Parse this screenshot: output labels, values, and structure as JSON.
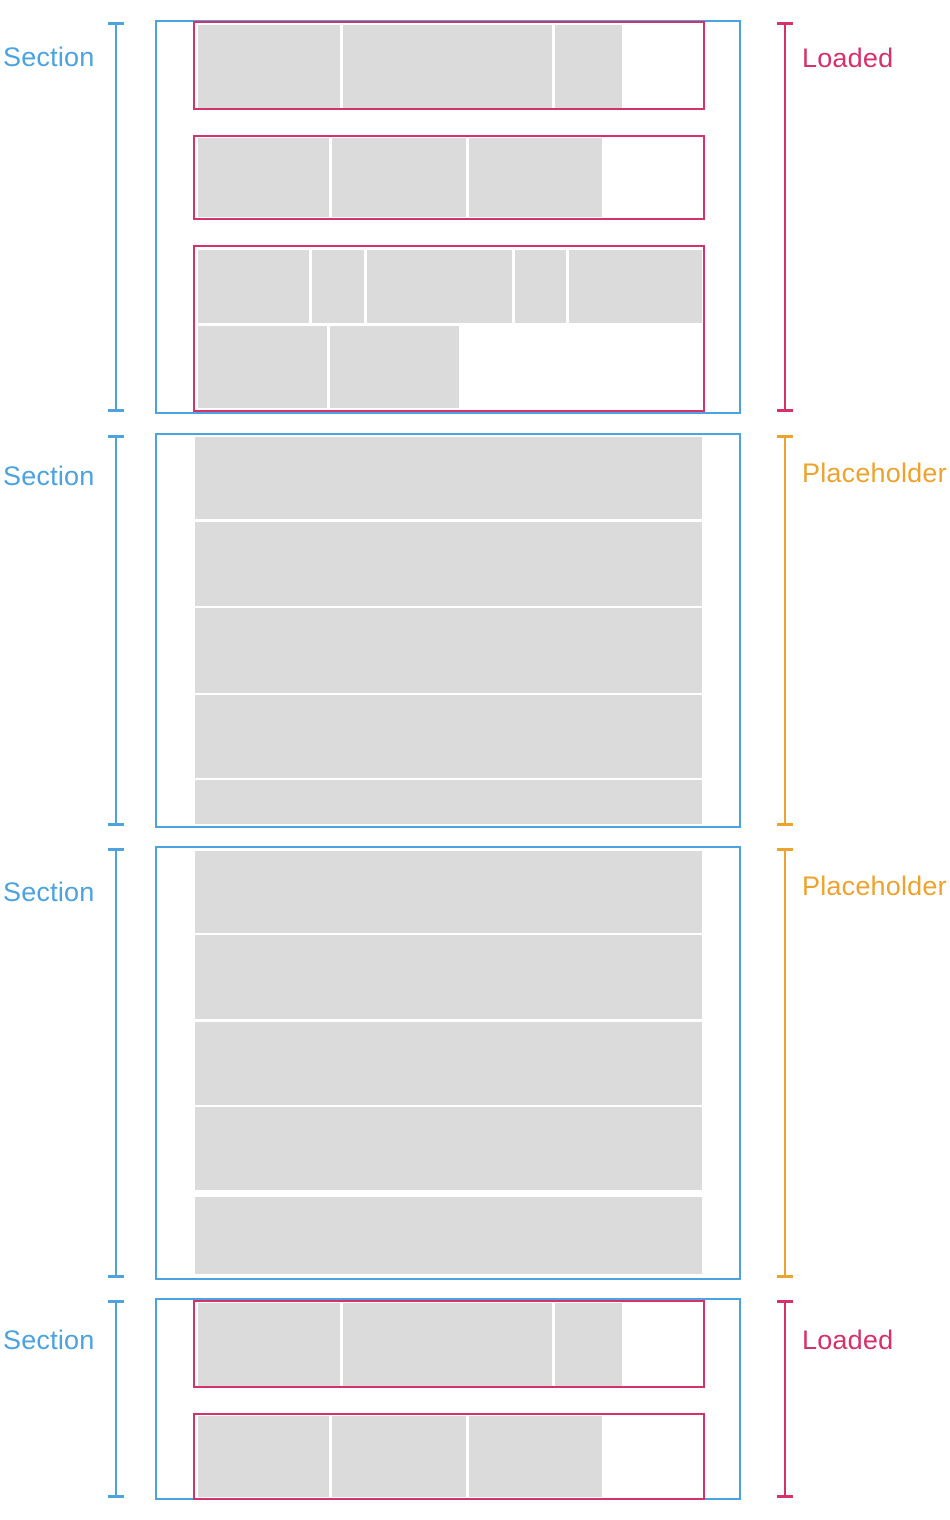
{
  "diagram_title": "Sections with loaded content and placeholder skeletons",
  "colors": {
    "section_outline_blue": "#4DA3DF",
    "loaded_pink": "#D5326B",
    "placeholder_orange": "#EDA32F",
    "skeleton_gray": "#DBDBDB",
    "background": "#FFFFFF"
  },
  "sections": [
    {
      "label": "Section",
      "state": "loaded",
      "state_label": "Loaded",
      "top": 20,
      "height": 394,
      "label_dy": 24,
      "state_label_dy": 25,
      "groups": [
        {
          "top": 1,
          "height": 89,
          "rows": [
            {
              "top": 4,
              "height": 83,
              "cells": [
                142,
                209,
                67
              ]
            }
          ]
        },
        {
          "top": 115,
          "height": 85,
          "rows": [
            {
              "top": 3,
              "height": 79,
              "cells": [
                131,
                134,
                133
              ]
            }
          ]
        },
        {
          "top": 225,
          "height": 167,
          "rows": [
            {
              "top": 5,
              "height": 73,
              "cells": [
                111,
                52,
                145,
                51,
                133
              ]
            },
            {
              "top": 81,
              "height": 82,
              "cells": [
                129,
                129
              ]
            }
          ]
        }
      ]
    },
    {
      "label": "Section",
      "state": "placeholder",
      "state_label": "Placeholder",
      "top": 433,
      "height": 395,
      "label_dy": 30,
      "state_label_dy": 27,
      "rows": [
        {
          "top": 4,
          "height": 82
        },
        {
          "top": 89,
          "height": 84
        },
        {
          "top": 175,
          "height": 85
        },
        {
          "top": 262,
          "height": 83
        },
        {
          "top": 347,
          "height": 44
        }
      ]
    },
    {
      "label": "Section",
      "state": "placeholder",
      "state_label": "Placeholder",
      "top": 846,
      "height": 434,
      "label_dy": 33,
      "state_label_dy": 27,
      "rows": [
        {
          "top": 5,
          "height": 82
        },
        {
          "top": 89,
          "height": 84
        },
        {
          "top": 176,
          "height": 83
        },
        {
          "top": 261,
          "height": 83
        },
        {
          "top": 351,
          "height": 77
        }
      ]
    },
    {
      "label": "Section",
      "state": "loaded",
      "state_label": "Loaded",
      "top": 1298,
      "height": 202,
      "label_dy": 29,
      "state_label_dy": 29,
      "groups": [
        {
          "top": 2,
          "height": 88,
          "rows": [
            {
              "top": 3,
              "height": 83,
              "cells": [
                142,
                209,
                67
              ]
            }
          ]
        },
        {
          "top": 115,
          "height": 87,
          "rows": [
            {
              "top": 3,
              "height": 81,
              "cells": [
                131,
                134,
                133
              ]
            }
          ]
        }
      ]
    }
  ]
}
